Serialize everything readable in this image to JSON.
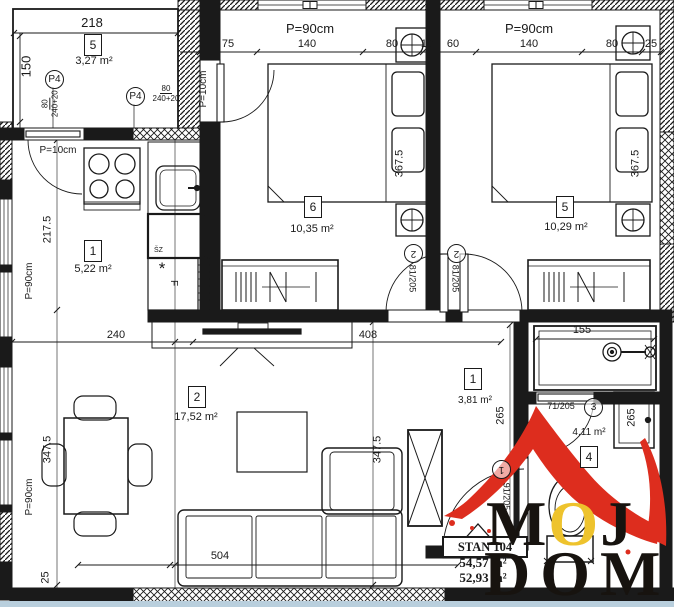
{
  "colors": {
    "line": "#1a1a1a",
    "logo_red": "#dd2d1e",
    "logo_yellow": "#eec32d",
    "bottom_strip": "#b9cfdd"
  },
  "rooms": {
    "terrace": {
      "num": "5",
      "area": "3,27 m²"
    },
    "bedroom_a": {
      "num": "6",
      "area": "10,35 m²"
    },
    "bedroom_b": {
      "num": "5",
      "area": "10,29 m²"
    },
    "kitchen": {
      "num": "1",
      "area": "5,22 m²"
    },
    "living": {
      "num": "2",
      "area": "17,52 m²"
    },
    "hall": {
      "num": "1",
      "area": "3,81 m²"
    },
    "bathroom": {
      "num": "4",
      "area": "4,11 m²"
    }
  },
  "doors": {
    "entry": {
      "size": "91/205",
      "mark": "1"
    },
    "bedroom_a": {
      "size": "81/205",
      "mark": "2"
    },
    "bedroom_b": {
      "size": "81/205",
      "mark": "2"
    },
    "bathroom": {
      "size": "71/205",
      "mark": "3"
    }
  },
  "windows": {
    "p4_label": "P4",
    "p4_num": "80",
    "p4_den": "240+20",
    "parapet_90": "P=90cm",
    "parapet_10": "P=10cm"
  },
  "dims": {
    "terrace_w": "218",
    "terrace_h": "150",
    "top": {
      "d1": "75",
      "d2": "140",
      "d3": "80",
      "d4": "10",
      "d5": "60",
      "d6": "140",
      "d7": "80",
      "d8": "25"
    },
    "bed_a_depth": "367.5",
    "bed_b_depth": "367.5",
    "kitchen_depth": "217.5",
    "living_w1": "240",
    "living_w2": "408",
    "living_depth_l": "347.5",
    "living_depth_r": "347.5",
    "sofa": "504",
    "wall": "25",
    "hall": "265",
    "bath": "265",
    "shower": "155"
  },
  "appliances": {
    "washer": "ŠZ",
    "fridge": "F",
    "note": "*"
  },
  "title": {
    "unit": "STAN 104",
    "area_1": "54,57 m²",
    "area_2": "52,93 m²"
  },
  "logo": {
    "m": "M",
    "o": "O",
    "j": "J",
    "word2": "DOM"
  }
}
